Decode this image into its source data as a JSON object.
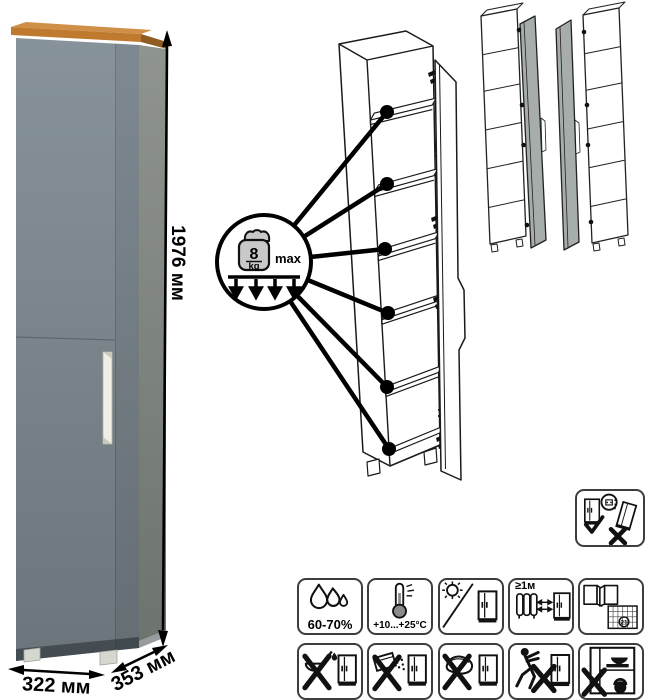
{
  "product": {
    "type_note": "tall single-door cabinet",
    "dimensions": {
      "height": "1976 мм",
      "width": "322 мм",
      "depth": "353 мм"
    }
  },
  "shelf_load_callout": {
    "value": "8",
    "unit": "kg",
    "qualifier": "max",
    "icon": "weight-icon"
  },
  "care_icons": {
    "row1": [
      {
        "name": "humidity",
        "icon": "water-drops-icon",
        "label": "60-70%"
      },
      {
        "name": "temperature-range",
        "icon": "thermometer-icon",
        "label": "+10...+25°C"
      },
      {
        "name": "no-direct-sunlight",
        "icon": "sun-icon",
        "label": ""
      },
      {
        "name": "heat-source-distance",
        "icon": "radiator-arrows-icon",
        "label": "≥1м"
      },
      {
        "name": "ventilation-acclimatization",
        "icon": "open-windows-calendar-icon",
        "label": "21"
      }
    ],
    "row2": [
      {
        "name": "no-aggressive-liquids",
        "icon": "ladle-drop-crossed-icon"
      },
      {
        "name": "no-abrasive-powders",
        "icon": "powder-box-crossed-icon"
      },
      {
        "name": "no-harsh-scrubbing",
        "icon": "scouring-pad-crossed-icon"
      },
      {
        "name": "no-dragging",
        "icon": "person-pushing-crossed-icon"
      },
      {
        "name": "no-overloading",
        "icon": "overloaded-cabinet-crossed-icon"
      }
    ],
    "anti_tip": {
      "name": "secure-to-wall",
      "icon": "wall-anchor-check-icon"
    }
  },
  "colors": {
    "door_front_light": "#87929a",
    "door_front_dark": "#6b757b",
    "side_light": "#8f948e",
    "side_dark": "#6d736d",
    "wood_top": "#c07a2f",
    "wood_top_sliver": "#cf8f47",
    "wood_side_edge": "#8f5c22",
    "handle": "#f0eee7",
    "drawing_door_gray": "#a7adab"
  }
}
